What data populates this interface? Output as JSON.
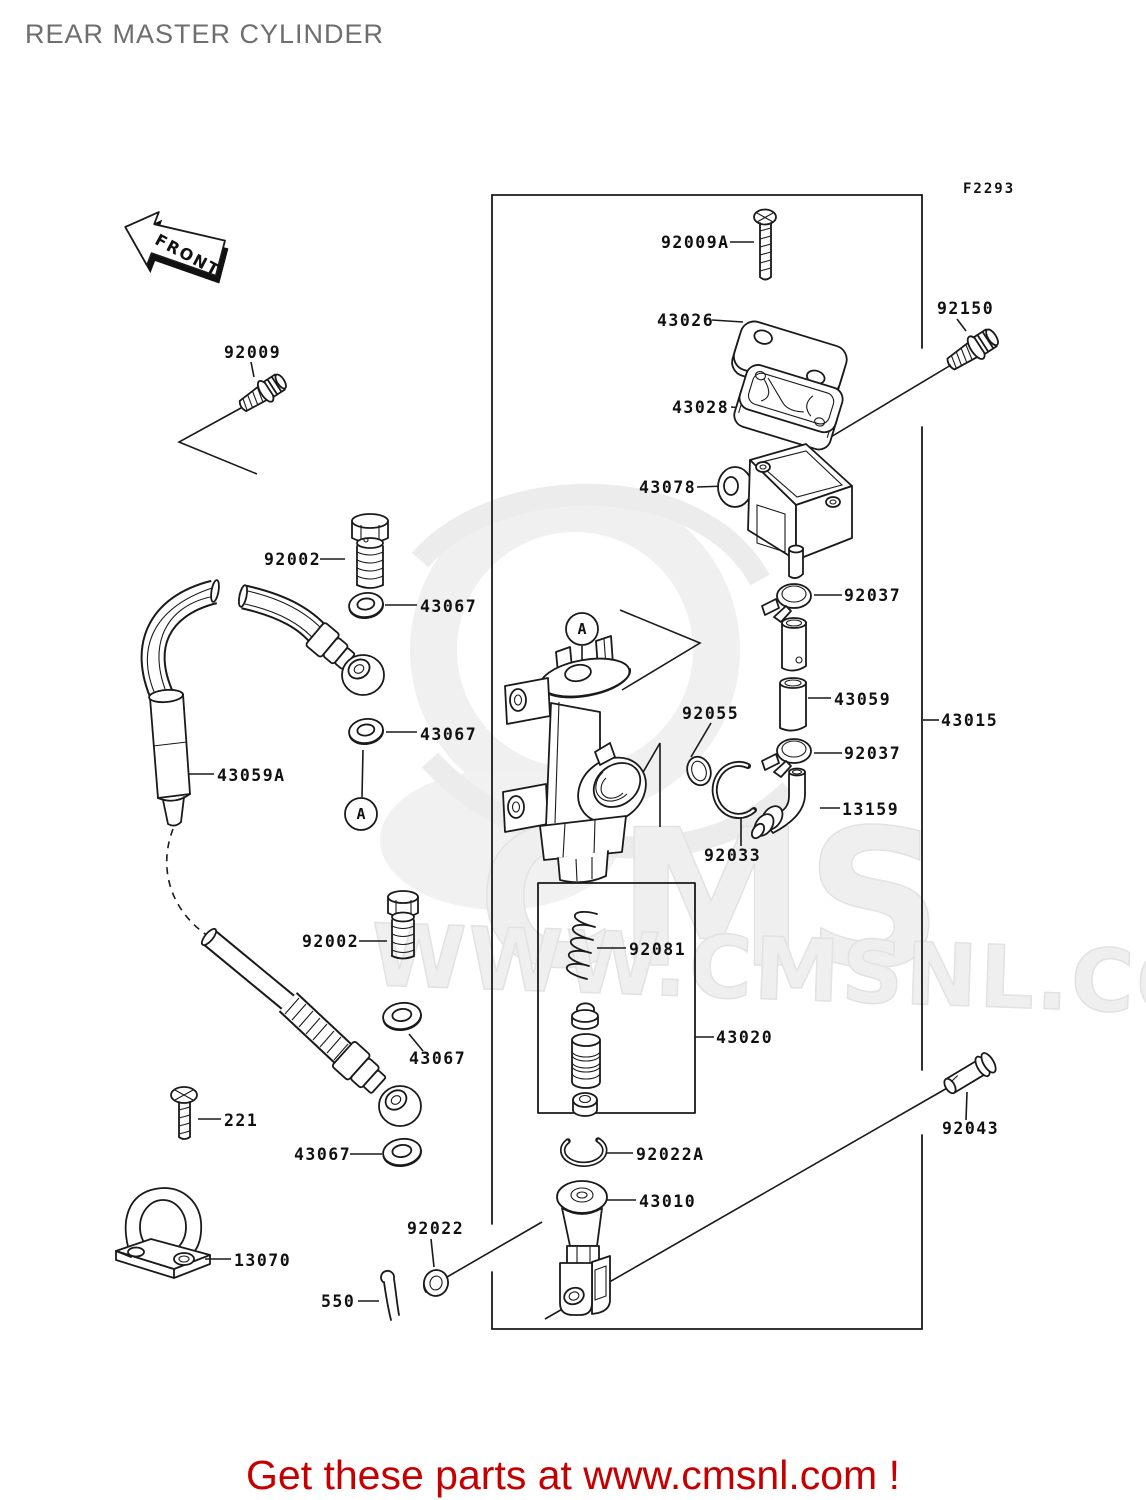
{
  "page": {
    "title": "REAR MASTER CYLINDER",
    "figure_code": "F2293",
    "front_label": "FRONT",
    "detail_marker": "A",
    "footer_link_text": "Get these parts at www.cmsnl.com !",
    "watermark": {
      "brand": "CMS",
      "site": "WWW.CMSNL.COM"
    },
    "colors": {
      "line": "#1a1a1a",
      "title_gray": "#6e6e6e",
      "footer_red": "#c60000",
      "watermark_gray": "#efefef"
    }
  },
  "labels": [
    {
      "id": "92009A",
      "text": "92009A"
    },
    {
      "id": "43026",
      "text": "43026"
    },
    {
      "id": "43028",
      "text": "43028"
    },
    {
      "id": "43078",
      "text": "43078"
    },
    {
      "id": "92150",
      "text": "92150"
    },
    {
      "id": "92009",
      "text": "92009"
    },
    {
      "id": "92002-a",
      "text": "92002"
    },
    {
      "id": "43067-a",
      "text": "43067"
    },
    {
      "id": "43067-b",
      "text": "43067"
    },
    {
      "id": "43059A",
      "text": "43059A"
    },
    {
      "id": "92002-b",
      "text": "92002"
    },
    {
      "id": "43067-c",
      "text": "43067"
    },
    {
      "id": "43067-d",
      "text": "43067"
    },
    {
      "id": "221",
      "text": "221"
    },
    {
      "id": "13070",
      "text": "13070"
    },
    {
      "id": "550",
      "text": "550"
    },
    {
      "id": "92022",
      "text": "92022"
    },
    {
      "id": "92022A",
      "text": "92022A"
    },
    {
      "id": "43010",
      "text": "43010"
    },
    {
      "id": "43020",
      "text": "43020"
    },
    {
      "id": "92081",
      "text": "92081"
    },
    {
      "id": "92055",
      "text": "92055"
    },
    {
      "id": "92033",
      "text": "92033"
    },
    {
      "id": "92037-a",
      "text": "92037"
    },
    {
      "id": "43059",
      "text": "43059"
    },
    {
      "id": "92037-b",
      "text": "92037"
    },
    {
      "id": "13159",
      "text": "13159"
    },
    {
      "id": "43015",
      "text": "43015"
    },
    {
      "id": "92043",
      "text": "92043"
    }
  ]
}
